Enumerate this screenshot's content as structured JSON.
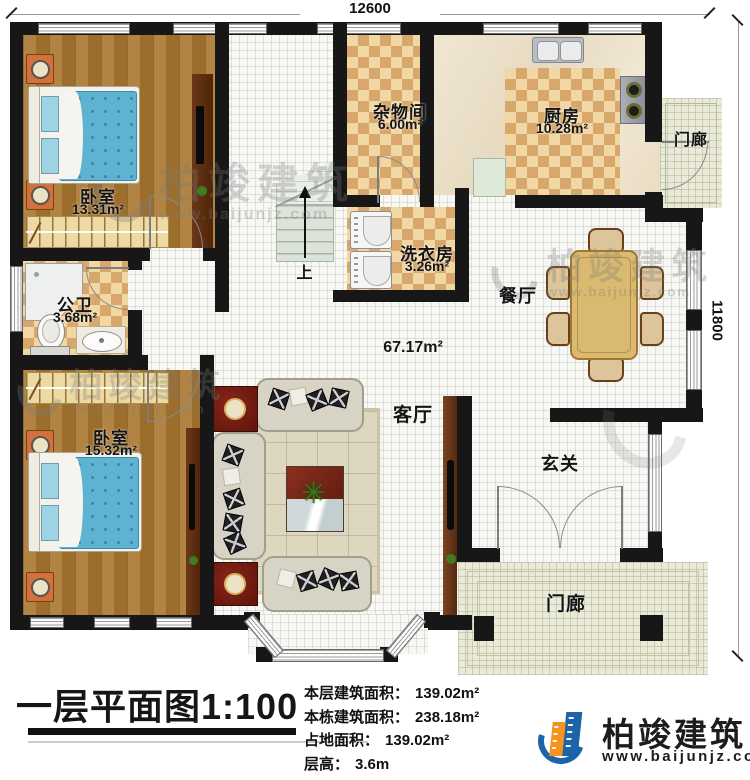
{
  "dimensions": {
    "top_width": "12600",
    "right_height": "11800"
  },
  "rooms": {
    "bedroom1": {
      "name": "卧室",
      "area": "13.31m²"
    },
    "bath": {
      "name": "公卫",
      "area": "3.68m²"
    },
    "bedroom2": {
      "name": "卧室",
      "area": "15.32m²"
    },
    "storage": {
      "name": "杂物间",
      "area": "6.00m²"
    },
    "laundry": {
      "name": "洗衣房",
      "area": "3.26m²"
    },
    "kitchen": {
      "name": "厨房",
      "area": "10.28m²"
    },
    "dining": {
      "name": "餐厅"
    },
    "living": {
      "name": "客厅"
    },
    "foyer": {
      "name": "玄关"
    },
    "porch_top": {
      "name": "门廊"
    },
    "porch_bottom": {
      "name": "门廊"
    }
  },
  "open_area": {
    "area": "67.17m²"
  },
  "stairs": {
    "up_label": "上"
  },
  "icons": {
    "plant": "✳"
  },
  "watermark": {
    "text": "柏竣建筑",
    "url": "www.baijunjz.com"
  },
  "footer": {
    "title": "一层平面图",
    "scale": "1:100",
    "stats": [
      {
        "label": "本层建筑面积：",
        "value": "139.02m²"
      },
      {
        "label": "本栋建筑面积：",
        "value": "238.18m²"
      },
      {
        "label": "占地面积：",
        "value": "139.02m²"
      },
      {
        "label": "层高：",
        "value": "3.6m"
      }
    ],
    "brand": {
      "name": "柏竣建筑",
      "url": "www.baijunjz.com"
    },
    "colors": {
      "brand_blue": "#1c63a8",
      "brand_orange": "#f6921e"
    }
  }
}
